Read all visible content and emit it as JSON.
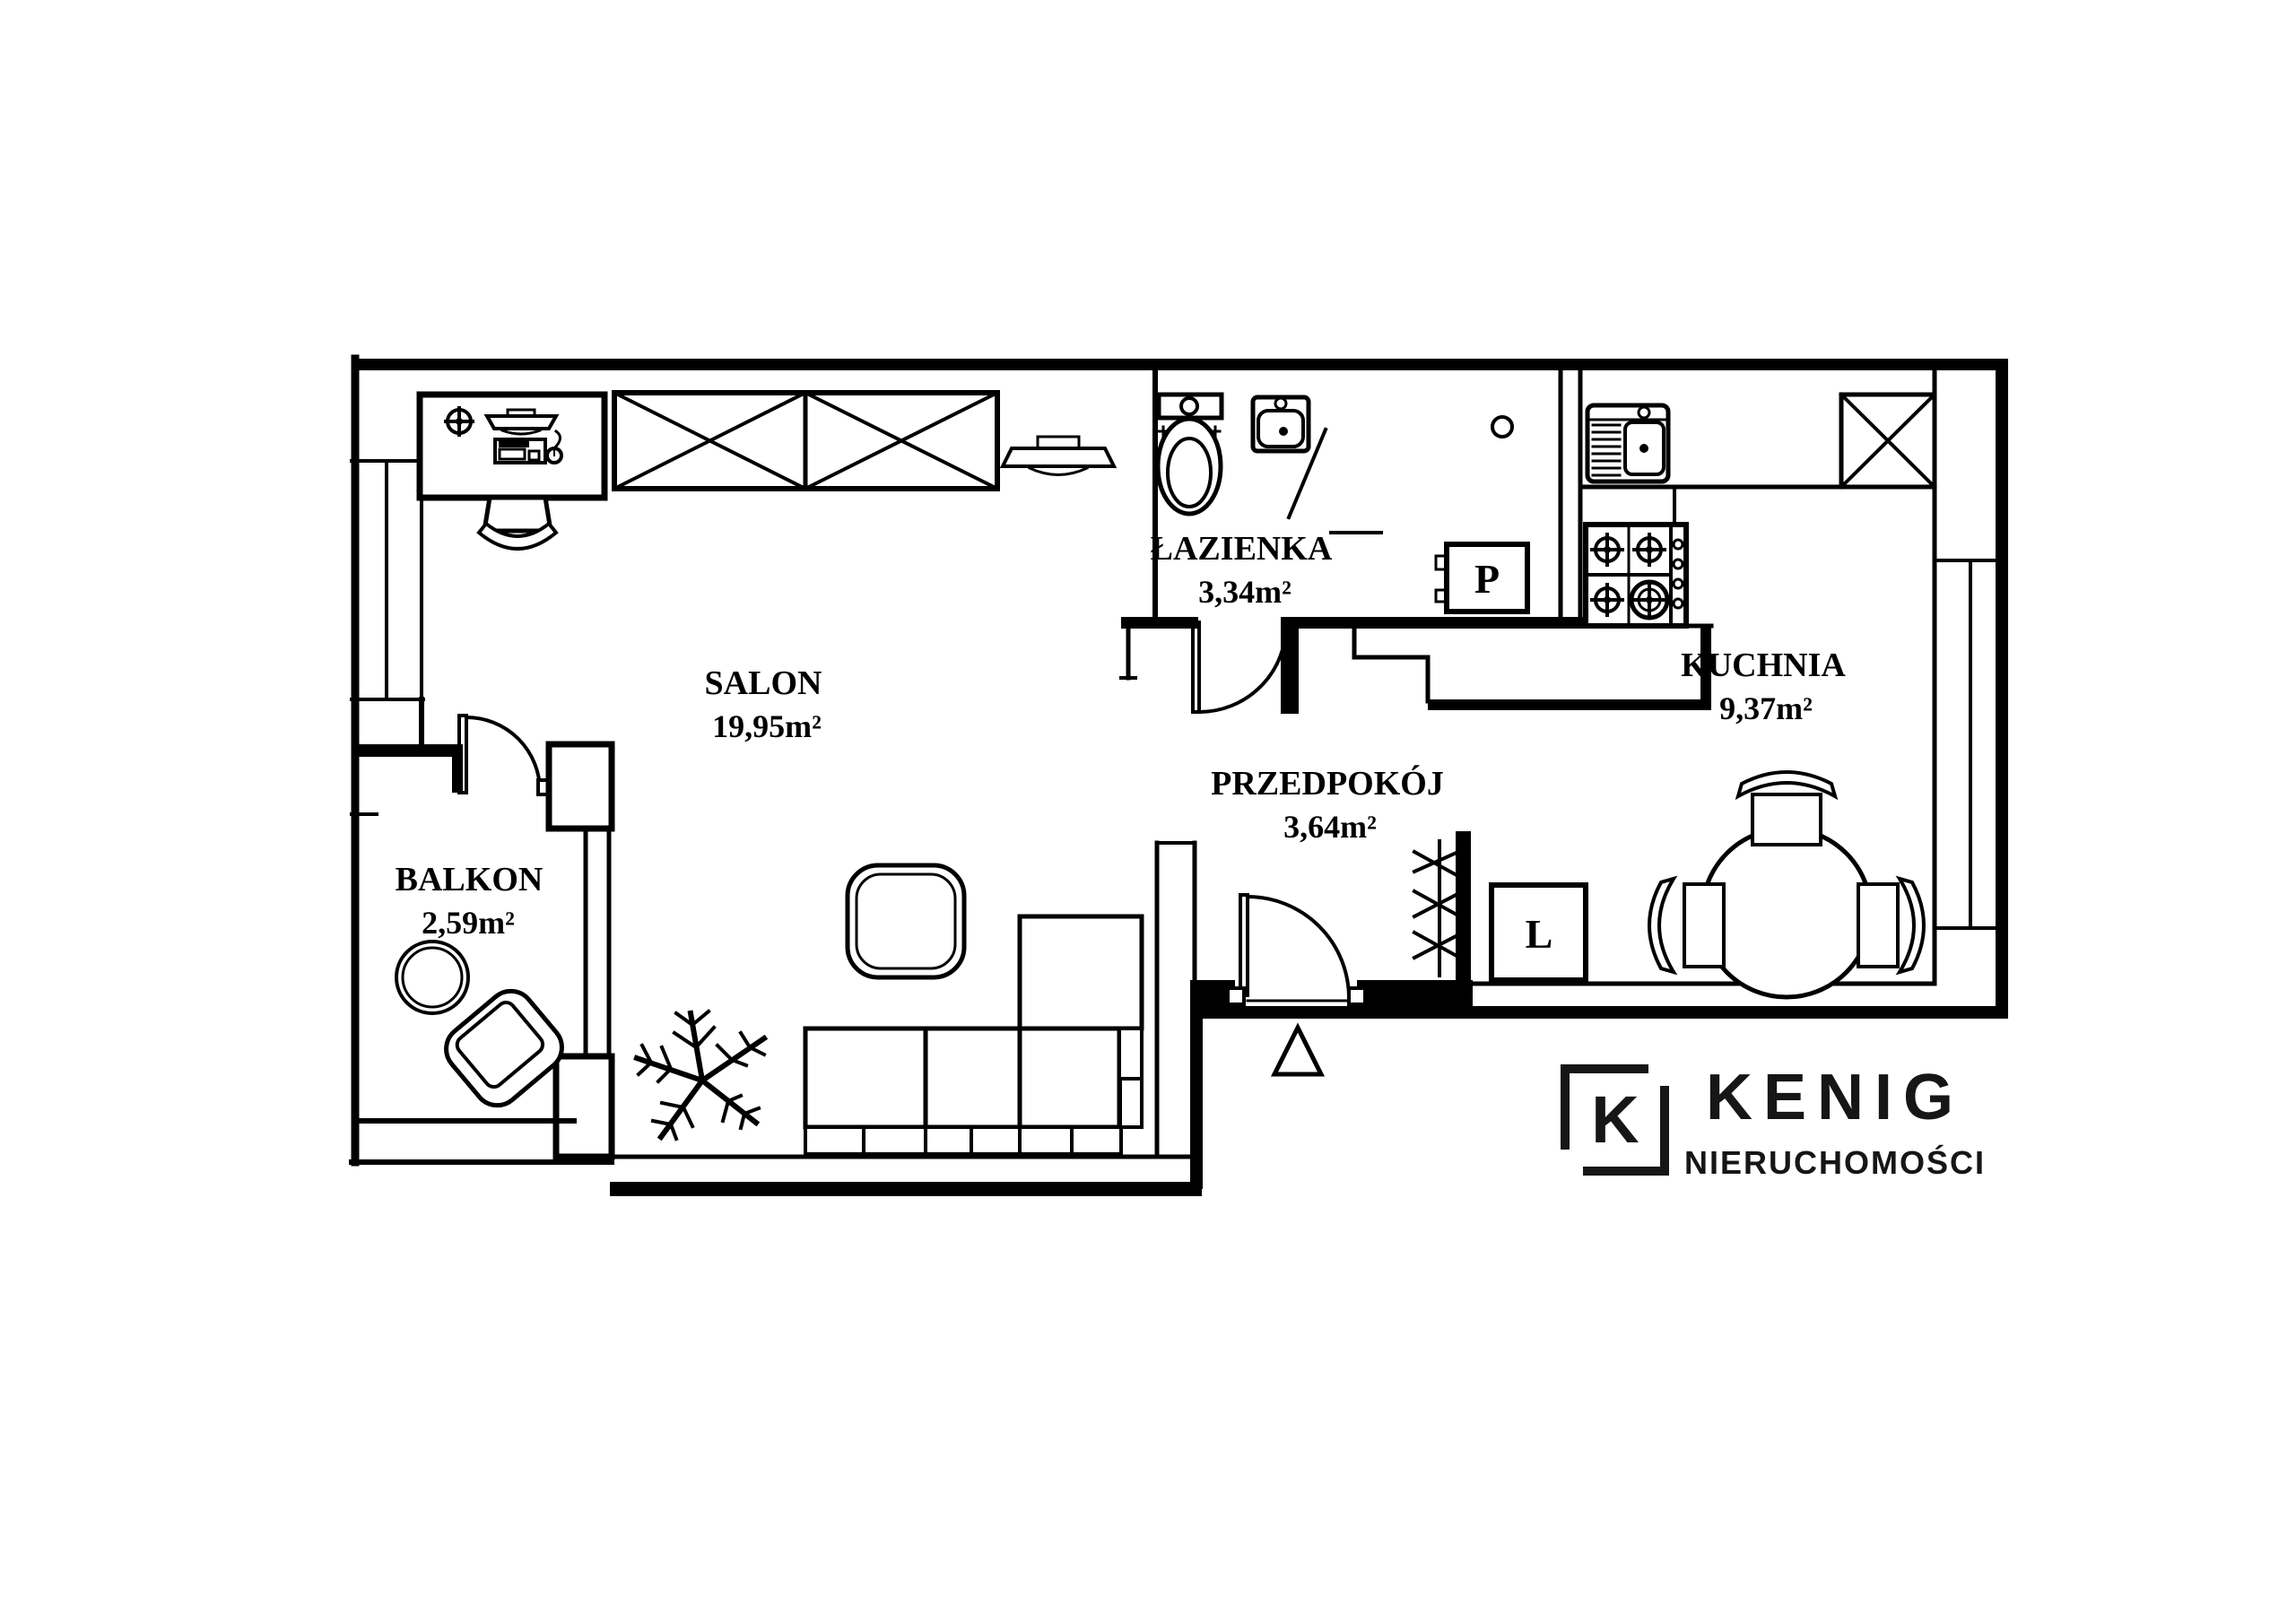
{
  "colors": {
    "line": "#000000",
    "background": "#ffffff",
    "logo": "#161616"
  },
  "rooms": [
    {
      "id": "salon",
      "name": "SALON",
      "area": "19,95m²"
    },
    {
      "id": "lazienka",
      "name": "ŁAZIENKA",
      "area": "3,34m²"
    },
    {
      "id": "kuchnia",
      "name": "KUCHNIA",
      "area": "9,37m²"
    },
    {
      "id": "przedpokoj",
      "name": "PRZEDPOKÓJ",
      "area": "3,64m²"
    },
    {
      "id": "balkon",
      "name": "BALKON",
      "area": "2,59m²"
    }
  ],
  "appliances": {
    "washing_machine_label": "P",
    "fridge_label": "L"
  },
  "logo": {
    "monogram": "K",
    "brand": "KENIG",
    "subtitle": "NIERUCHOMOŚCI"
  }
}
